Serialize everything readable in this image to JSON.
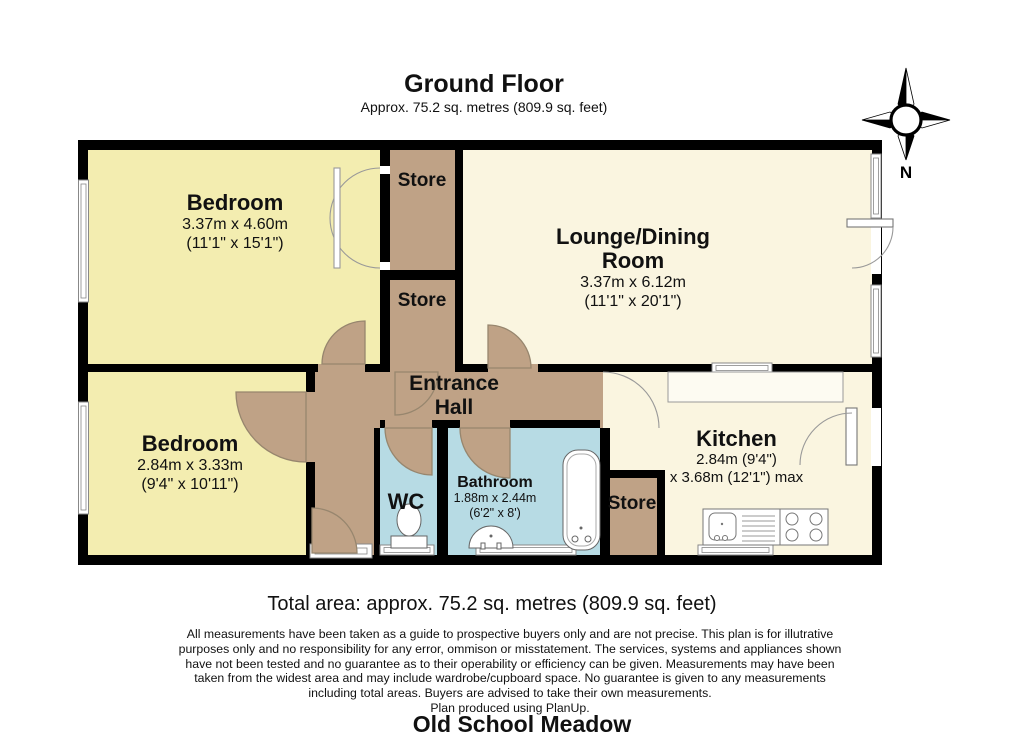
{
  "page": {
    "title": "Ground Floor",
    "subtitle": "Approx. 75.2 sq. metres (809.9 sq. feet)",
    "total_area": "Total area: approx. 75.2 sq. metres (809.9 sq. feet)",
    "disclaimer_lines": [
      "All measurements have been taken as a guide to prospective buyers only and are not precise. This plan is for illutrative",
      "purposes only and no responsibility for any error, ommison or misstatement. The services, systems and appliances shown",
      "have not been tested and no guarantee as to their operability or efficiency can be given. Measurements may have been",
      "taken from the widest area and may include wardrobe/cupboard space. No guarantee is given to any measurements",
      "including total areas. Buyers are advised to take their own measurements.",
      "Plan produced using PlanUp."
    ],
    "footer_title": "Old School Meadow",
    "compass_label": "N"
  },
  "rooms": {
    "bedroom_top": {
      "name": "Bedroom",
      "dim_metric": "3.37m x 4.60m",
      "dim_imperial": "(11'1\" x 15'1\")"
    },
    "store_top": {
      "name": "Store"
    },
    "store_middle": {
      "name": "Store"
    },
    "lounge": {
      "name": "Lounge/Dining Room",
      "dim_metric": "3.37m x 6.12m",
      "dim_imperial": "(11'1\" x 20'1\")"
    },
    "bedroom_bottom": {
      "name": "Bedroom",
      "dim_metric": "2.84m x 3.33m",
      "dim_imperial": "(9'4\" x 10'11\")"
    },
    "entrance_hall": {
      "name": "Entrance Hall"
    },
    "wc": {
      "name": "WC"
    },
    "bathroom": {
      "name": "Bathroom",
      "dim_metric": "1.88m x 2.44m",
      "dim_imperial": "(6'2\" x 8')"
    },
    "store_kitchen": {
      "name": "Store"
    },
    "kitchen": {
      "name": "Kitchen",
      "dim_line1": "2.84m (9'4\")",
      "dim_line2": "x 3.68m (12'1\") max"
    }
  },
  "colors": {
    "walls": "#000000",
    "bedroom_fill": "#f3edb0",
    "living_fill": "#faf5e0",
    "hall_store_fill": "#bfa286",
    "bathroom_fill": "#b7dbe4",
    "fixture_outline": "#777777"
  }
}
